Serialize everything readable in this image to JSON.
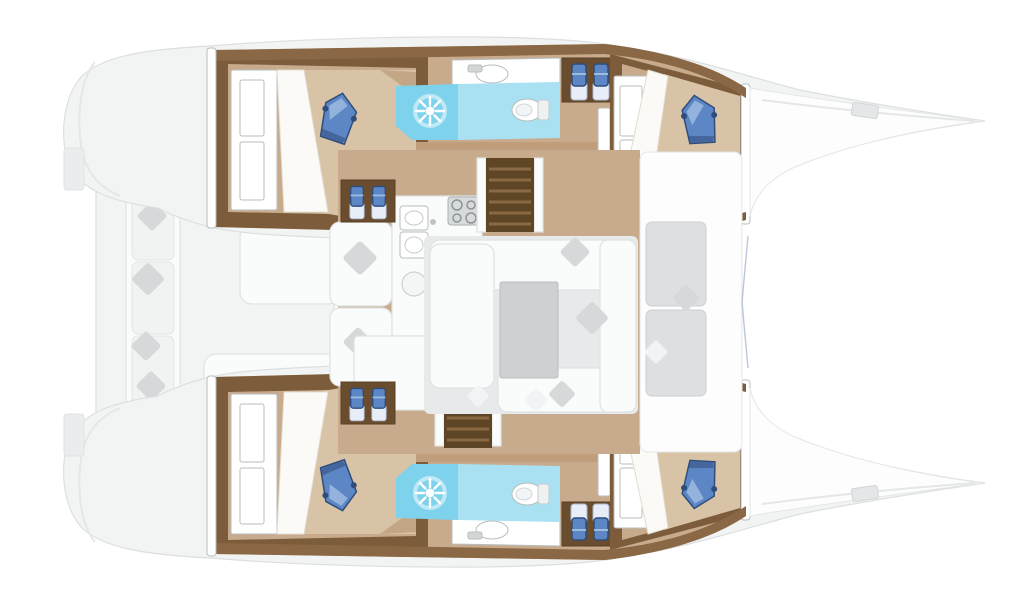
{
  "scene": {
    "kind": "catamaran-interior-floor-plan",
    "orientation": "bow-right"
  },
  "icons": {
    "shower-jet-icon": "white starburst on cyan floor",
    "toilet-icon": "white oval with seat ring",
    "sink-icon": "oval basin in white counter",
    "stove-icon": "gray square with four burner rings",
    "stairs-icon": "dark striped rectangle",
    "pillow-icon": "rotated blue cushion",
    "throw-pillow-icon": "rotated gray square",
    "step-bottle-icon": "small blue block with white base"
  },
  "colors": {
    "page-bg": "#ffffff",
    "hull-faded": "#f2f4f4",
    "hull-stroke": "#dcdfe0",
    "hull-contour": "#e4e7e7",
    "deck-white": "#fdfdfd",
    "tan-mid": "#c7ab8c",
    "tan-dark": "#c09e7c",
    "tan-light": "#d8c3a6",
    "tan-deep": "#b5926f",
    "sheet-white": "#fbfaf7",
    "sheet-edge": "#e3ddd0",
    "trim-brown": "#7d5c3c",
    "trim-brown-light": "#8a6845",
    "step-dark": "#5e4526",
    "step-line": "#8a6a44",
    "cyan-main": "#7ed2ec",
    "cyan-light": "#a9e1f3",
    "pillow-blue": "#5d86c5",
    "pillow-navy": "#2f4d7c",
    "pillow-light": "#9cbbdf",
    "white": "#ffffff",
    "fixture-stroke": "#b8bdbe",
    "furn-white": "#fafbfb",
    "furn-stroke": "#e0e3e3",
    "cushion-gray": "#dddfe1",
    "cushion-stroke": "#cdd0d2",
    "diamond-gray": "#d6d9da",
    "table-gray": "#cdd1d4",
    "table-stroke": "#b9bec1",
    "floor-gray": "#e7e9ea",
    "bow-line-blue": "#9aa8c8"
  }
}
